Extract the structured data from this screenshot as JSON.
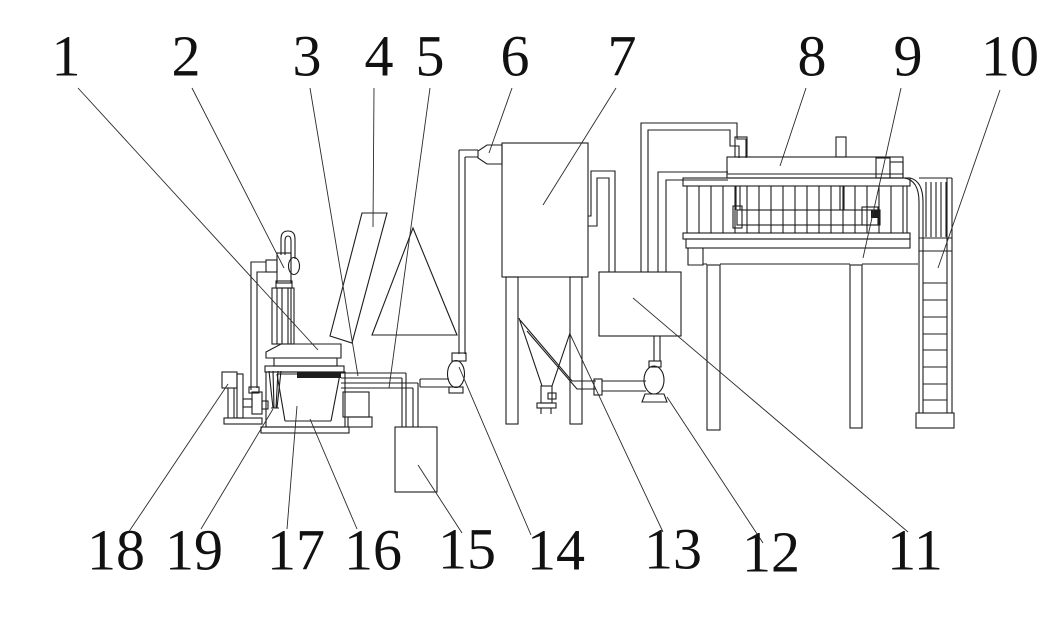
{
  "figure": {
    "background": "#ffffff",
    "ink_color": "#1c1c1c",
    "callouts": {
      "c1": "1",
      "c2": "2",
      "c3": "3",
      "c4": "4",
      "c5": "5",
      "c6": "6",
      "c7": "7",
      "c8": "8",
      "c9": "9",
      "c10": "10",
      "c11": "11",
      "c12": "12",
      "c13": "13",
      "c14": "14",
      "c15": "15",
      "c16": "16",
      "c17": "17",
      "c18": "18",
      "c19": "19"
    }
  }
}
